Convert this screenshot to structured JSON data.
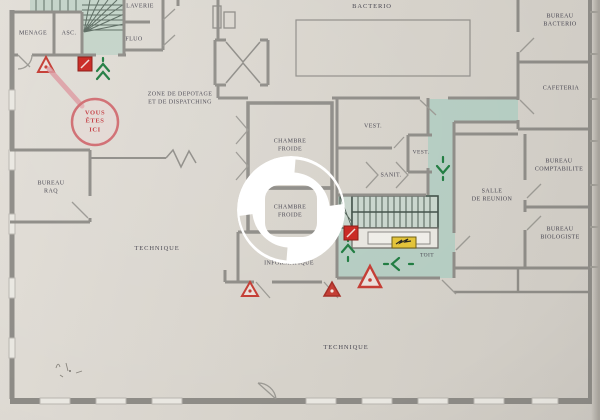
{
  "plan": {
    "labels": [
      {
        "id": "menage",
        "label": "MENAGE"
      },
      {
        "id": "asc",
        "label": "ASC."
      },
      {
        "id": "laverie",
        "label": "LAVERIE"
      },
      {
        "id": "fluo",
        "label": "FLUO"
      },
      {
        "id": "bacterio",
        "label": "BACTERIO"
      },
      {
        "id": "bureau-bacterio",
        "label": "BUREAU\nBACTERIO"
      },
      {
        "id": "cafeteria",
        "label": "CAFETERIA"
      },
      {
        "id": "zone-depotage",
        "label": "ZONE DE DEPOTAGE\nET DE DISPATCHING"
      },
      {
        "id": "vous-etes-ici",
        "label": "VOUS\nÊTES\nICI"
      },
      {
        "id": "chambre-froide-1",
        "label": "CHAMBRE\nFROIDE"
      },
      {
        "id": "vest-1",
        "label": "VEST."
      },
      {
        "id": "vest-2",
        "label": "VEST."
      },
      {
        "id": "sanit",
        "label": "SANIT."
      },
      {
        "id": "bureau-raq",
        "label": "BUREAU\nRAQ"
      },
      {
        "id": "salle-de-reunion",
        "label": "SALLE\nDE REUNION"
      },
      {
        "id": "bureau-comptabilite",
        "label": "BUREAU\nCOMPTABILITE"
      },
      {
        "id": "chambre-froide-2",
        "label": "CHAMBRE\nFROIDE"
      },
      {
        "id": "bureau-biologiste",
        "label": "BUREAU\nBIOLOGISTE"
      },
      {
        "id": "technique-1",
        "label": "TECHNIQUE"
      },
      {
        "id": "informatique",
        "label": "INFORMATIQUE"
      },
      {
        "id": "toit",
        "label": "TOIT"
      },
      {
        "id": "technique-2",
        "label": "TECHNIQUE"
      }
    ],
    "marker_label": "VOUS\nÊTES\nICI",
    "symbols": {
      "warning_triangle_count": 4,
      "fire_extinguisher_count": 2,
      "exit_arrow_count": 4,
      "electrical_panel_count": 1
    },
    "colors": {
      "paper_beige": "#d9d5cd",
      "wall_gray": "#8d8b86",
      "evac_route_green": "#b4ccc1",
      "stair_green": "#c3d3c8",
      "arrow_green": "#1d7a3e",
      "alert_red": "#c33a31",
      "extinguisher_red": "#c8241e",
      "panel_yellow": "#e2c235",
      "marker_red": "#c2393f",
      "marker_pink": "#dc99a0"
    }
  }
}
